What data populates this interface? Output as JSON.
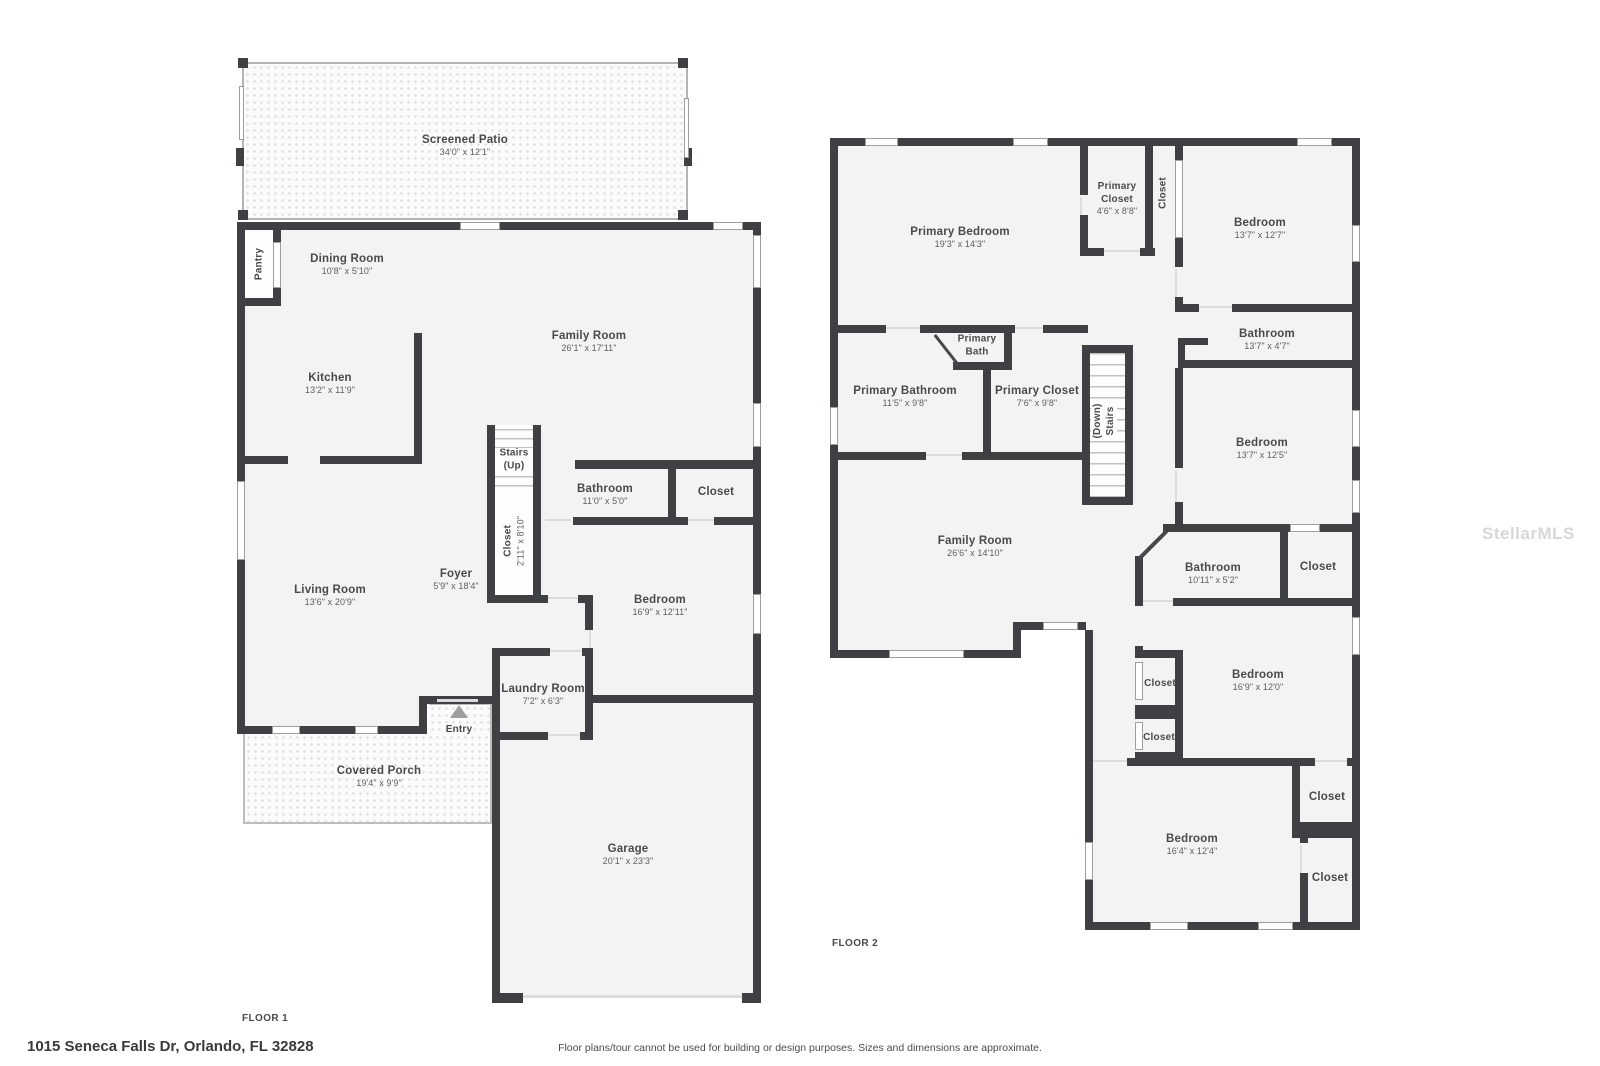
{
  "address": "1015 Seneca Falls Dr, Orlando, FL 32828",
  "disclaimer": "Floor plans/tour cannot be used for building or design purposes. Sizes and dimensions are approximate.",
  "watermark": "StellarMLS",
  "floor1": {
    "title": "FLOOR 1",
    "rooms": {
      "screened_patio": {
        "name": "Screened Patio",
        "dims": "34'0\" x 12'1\""
      },
      "pantry": {
        "name": "Pantry"
      },
      "dining_room": {
        "name": "Dining Room",
        "dims": "10'8\" x 5'10\""
      },
      "family_room": {
        "name": "Family Room",
        "dims": "26'1\" x 17'11\""
      },
      "kitchen": {
        "name": "Kitchen",
        "dims": "13'2\" x 11'9\""
      },
      "stairs": {
        "name": "Stairs",
        "dims": "(Up)"
      },
      "closet_foyer": {
        "name": "Closet",
        "dims": "2'11\" x 8'10\""
      },
      "bathroom": {
        "name": "Bathroom",
        "dims": "11'0\" x 5'0\""
      },
      "closet_hall": {
        "name": "Closet"
      },
      "foyer": {
        "name": "Foyer",
        "dims": "5'9\" x 18'4\""
      },
      "living_room": {
        "name": "Living Room",
        "dims": "13'6\" x 20'9\""
      },
      "bedroom": {
        "name": "Bedroom",
        "dims": "16'9\" x 12'11\""
      },
      "laundry_room": {
        "name": "Laundry Room",
        "dims": "7'2\" x 6'3\""
      },
      "entry": {
        "name": "Entry"
      },
      "covered_porch": {
        "name": "Covered Porch",
        "dims": "19'4\" x 9'9\""
      },
      "garage": {
        "name": "Garage",
        "dims": "20'1\" x 23'3\""
      }
    }
  },
  "floor2": {
    "title": "FLOOR 2",
    "rooms": {
      "primary_bedroom": {
        "name": "Primary Bedroom",
        "dims": "19'3\" x 14'3\""
      },
      "primary_closet_small": {
        "name": "Primary Closet",
        "dims": "4'6\" x 8'8\""
      },
      "closet_top": {
        "name": "Closet"
      },
      "bedroom_top_right": {
        "name": "Bedroom",
        "dims": "13'7\" x 12'7\""
      },
      "bathroom_right": {
        "name": "Bathroom",
        "dims": "13'7\" x 4'7\""
      },
      "primary_bath": {
        "name": "Primary Bath"
      },
      "primary_bathroom": {
        "name": "Primary Bathroom",
        "dims": "11'5\" x 9'8\""
      },
      "primary_closet": {
        "name": "Primary Closet",
        "dims": "7'6\" x 9'8\""
      },
      "stairs": {
        "name": "Stairs",
        "dims": "(Down)"
      },
      "bedroom_mid_right": {
        "name": "Bedroom",
        "dims": "13'7\" x 12'5\""
      },
      "family_room": {
        "name": "Family Room",
        "dims": "26'6\" x 14'10\""
      },
      "bathroom_mid": {
        "name": "Bathroom",
        "dims": "10'11\" x 5'2\""
      },
      "closet_mid": {
        "name": "Closet"
      },
      "bedroom_right": {
        "name": "Bedroom",
        "dims": "16'9\" x 12'0\""
      },
      "closet_a": {
        "name": "Closet"
      },
      "closet_b": {
        "name": "Closet"
      },
      "bedroom_bottom": {
        "name": "Bedroom",
        "dims": "16'4\" x 12'4\""
      },
      "closet_c": {
        "name": "Closet"
      },
      "closet_d": {
        "name": "Closet"
      }
    }
  }
}
